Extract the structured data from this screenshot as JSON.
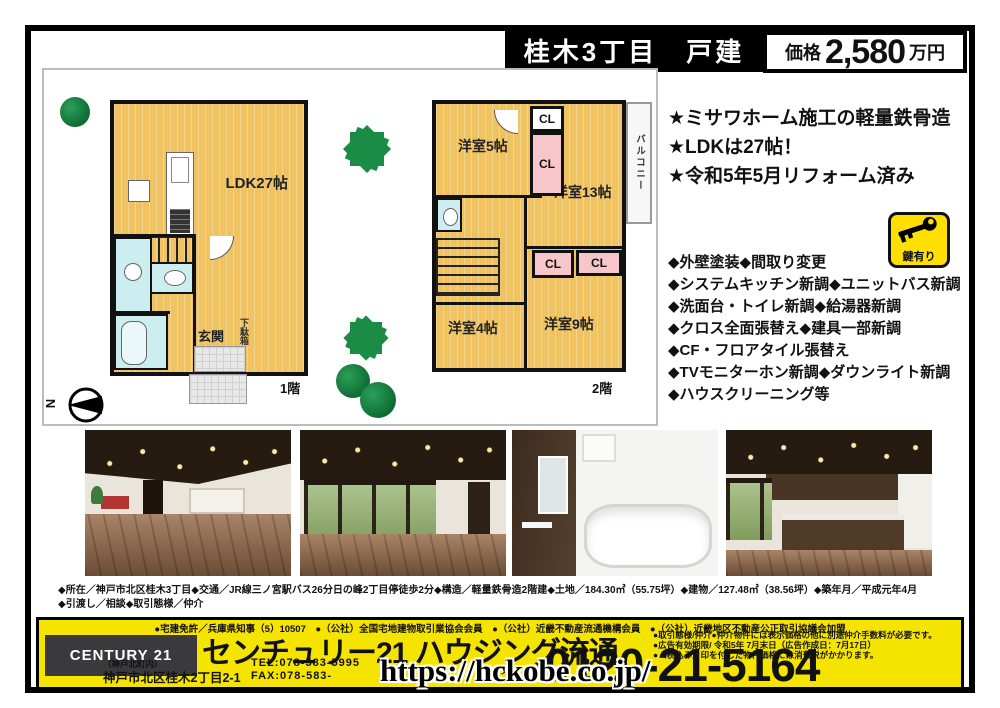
{
  "header": {
    "title": "桂木3丁目　戸建",
    "price_label": "価格",
    "price_value": "2,580",
    "price_unit": "万円"
  },
  "highlights": [
    "★ミサワホーム施工の軽量鉄骨造",
    "★LDKは27帖！",
    "★令和5年5月リフォーム済み"
  ],
  "key_badge": {
    "label": "鍵有り"
  },
  "features": [
    "◆外壁塗装◆間取り変更",
    "◆システムキッチン新調◆ユニットバス新調",
    "◆洗面台・トイレ新調◆給湯器新調",
    "◆クロス全面張替え◆建具一部新調",
    "◆CF・フロアタイル張替え",
    "◆TVモニターホン新調◆ダウンライト新調",
    "◆ハウスクリーニング等"
  ],
  "floorplan": {
    "compass": "N",
    "floor1": {
      "label": "1階",
      "ldk": "LDK27帖",
      "genkan": "玄関",
      "getabako": "下駄箱"
    },
    "floor2": {
      "label": "2階",
      "room5": "洋室5帖",
      "room13": "洋室13帖",
      "room4": "洋室4帖",
      "room9": "洋室9帖",
      "cl": "CL",
      "balcony": "バルコニー"
    }
  },
  "photos": [
    "living-room-interior",
    "living-room-windows",
    "bathroom",
    "kitchen"
  ],
  "details": {
    "line1": "◆所在／神戸市北区桂木3丁目◆交通／JR線三ノ宮駅バス26分日の峰2丁目停徒歩2分◆構造／軽量鉄骨造2階建◆土地／184.30㎡（55.75坪）◆建物／127.48㎡（38.56坪）◆築年月／平成元年4月",
    "line2": "◆引渡し／相談◆取引態様／仲介"
  },
  "footer": {
    "license": "●宅建免許／兵庫県知事（5）10507　●（公社）全国宅地建物取引業協会会員　●（公社）近畿不動産流通機構会員　●（公社）近畿地区不動産公正取引協議会加盟",
    "logo": "CENTURY 21",
    "company": "センチュリー21 ハウジング流通",
    "branch": "（神戸北町内）",
    "address": "神戸市北区桂木2丁目2-1",
    "tel": "TEL:078-583-5995",
    "fax": "FAX:078-583-",
    "freedial": "フリーダイヤル",
    "phone": "0120-21-5164",
    "notes": [
      "●取引態様/仲介●仲介物件には表示価格の他に別途仲介手数料が必要です。",
      "●広告有効期限/ 令和5年 7月末日（広告作成日：7月17日）",
      "●（税込み）印を付した物件価格には消費税がかかります。"
    ]
  },
  "watermark": "https://hckobe.co.jp/",
  "colors": {
    "footer_yellow": "#f5e300",
    "plan_tan": "#efc361",
    "closet_pink": "#f6c6ca",
    "wet_blue": "#cdeef0",
    "tree_green": "#1b8c46",
    "key_yellow": "#ffdf00"
  }
}
